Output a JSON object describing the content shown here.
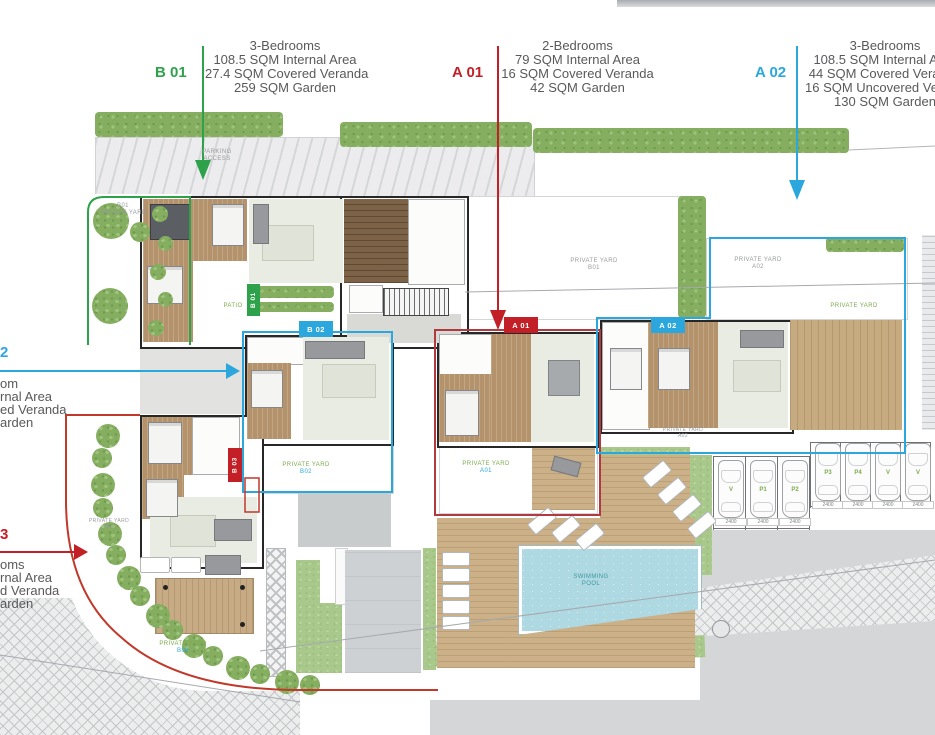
{
  "colors": {
    "green": "#2ea24a",
    "red": "#c22026",
    "blue": "#2ba7de",
    "dark_red_outline": "#b03a3f",
    "hedge_green": "#85ae60",
    "pool_blue": "#aed9e2",
    "deck_wood": "#cbb088",
    "text_gray": "#58595b"
  },
  "callouts": {
    "b01": {
      "id": "B 01",
      "lines": [
        "3-Bedrooms",
        "108.5 SQM Internal Area",
        "27.4 SQM Covered Veranda",
        "259 SQM Garden"
      ]
    },
    "a01": {
      "id": "A 01",
      "lines": [
        "2-Bedrooms",
        "79 SQM Internal Area",
        "16 SQM Covered Veranda",
        "42 SQM Garden"
      ]
    },
    "a02": {
      "id": "A 02",
      "lines": [
        "3-Bedrooms",
        "108.5 SQM Internal Area",
        "44 SQM Covered Veranda",
        "16 SQM Uncovered Veranda",
        "130 SQM Garden"
      ]
    },
    "b02_left": {
      "id": "2",
      "lines": [
        "om",
        "rnal Area",
        "ed Veranda",
        "arden"
      ]
    },
    "b03_left": {
      "id": "3",
      "lines": [
        "oms",
        "rnal Area",
        "d Veranda",
        "arden"
      ]
    }
  },
  "plan": {
    "tags": {
      "b01": "B 01",
      "b02": "B 02",
      "a01": "A 01",
      "a02": "A 02",
      "b03": "B 03"
    },
    "labels": {
      "parking_access": [
        "PARKING",
        "ACCESS"
      ],
      "b01_left": [
        "B01",
        "PRIVATE YARD"
      ],
      "b01_mid": [
        "PRIVATE YARD",
        "B01"
      ],
      "a02_top": [
        "PRIVATE YARD",
        "A02"
      ],
      "right_deck": [
        "PRIVATE YARD"
      ],
      "a02_low": [
        "PRIVATE YARD",
        "A02"
      ],
      "b02": [
        "PRIVATE YARD",
        "B02"
      ],
      "a01": [
        "PRIVATE YARD",
        "A01"
      ],
      "b03": [
        "PRIVATE YARD",
        "B03"
      ],
      "b03_small": [
        "PRIVATE YARD",
        "B03"
      ],
      "patio": "PATIO",
      "pool": [
        "SWIMMING",
        "POOL"
      ]
    }
  },
  "parking": {
    "spaces": [
      {
        "label": "V",
        "dim": "2400"
      },
      {
        "label": "P1",
        "dim": "2400"
      },
      {
        "label": "P2",
        "dim": "2400"
      },
      {
        "label": "P3",
        "dim": "2400"
      },
      {
        "label": "P4",
        "dim": "2400"
      },
      {
        "label": "V",
        "dim": "2400"
      },
      {
        "label": "V",
        "dim": "2400"
      }
    ]
  }
}
